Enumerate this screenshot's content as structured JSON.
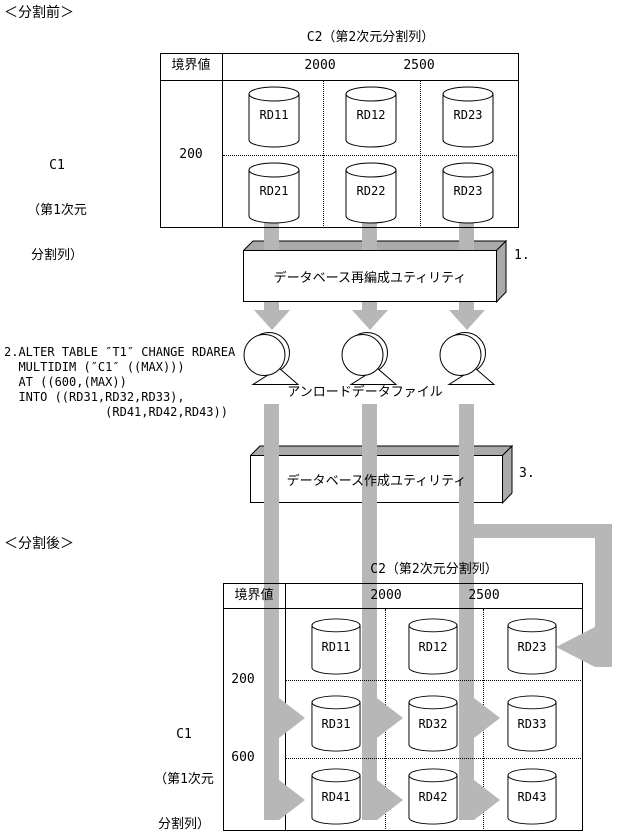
{
  "page": {
    "before_label": "＜分割前＞",
    "after_label": "＜分割後＞"
  },
  "colors": {
    "arrow_gray": "#b7b7b7",
    "box_face_gray": "#aaaaaa",
    "line_black": "#000000"
  },
  "steps": {
    "step1": "1.",
    "step3": "3."
  },
  "sql": {
    "lines": [
      "2.ALTER TABLE ″T1″ CHANGE RDAREA",
      "  MULTIDIM (″C1″ ((MAX)))",
      "  AT ((600,(MAX))",
      "  INTO ((RD31,RD32,RD33),",
      "              (RD41,RD42,RD43))"
    ]
  },
  "utilities": {
    "reorg_label": "データベース再編成ユティリティ",
    "create_label": "データベース作成ユティリティ"
  },
  "unload_file_label": "アンロードデータファイル",
  "before_table": {
    "c2_header": "C2（第2次元分割列）",
    "boundary_header": "境界値",
    "c2_boundaries": [
      "2000",
      "2500"
    ],
    "c1_label_lines": [
      "C1",
      "（第1次元",
      "分割列）"
    ],
    "c1_boundaries": [
      "200"
    ],
    "rows": [
      [
        "RD11",
        "RD12",
        "RD23"
      ],
      [
        "RD21",
        "RD22",
        "RD23"
      ]
    ]
  },
  "after_table": {
    "c2_header": "C2（第2次元分割列）",
    "boundary_header": "境界値",
    "c2_boundaries": [
      "2000",
      "2500"
    ],
    "c1_label_lines": [
      "C1",
      "（第1次元",
      "分割列）"
    ],
    "c1_boundaries": [
      "200",
      "600"
    ],
    "rows": [
      [
        "RD11",
        "RD12",
        "RD23"
      ],
      [
        "RD31",
        "RD32",
        "RD33"
      ],
      [
        "RD41",
        "RD42",
        "RD43"
      ]
    ]
  }
}
